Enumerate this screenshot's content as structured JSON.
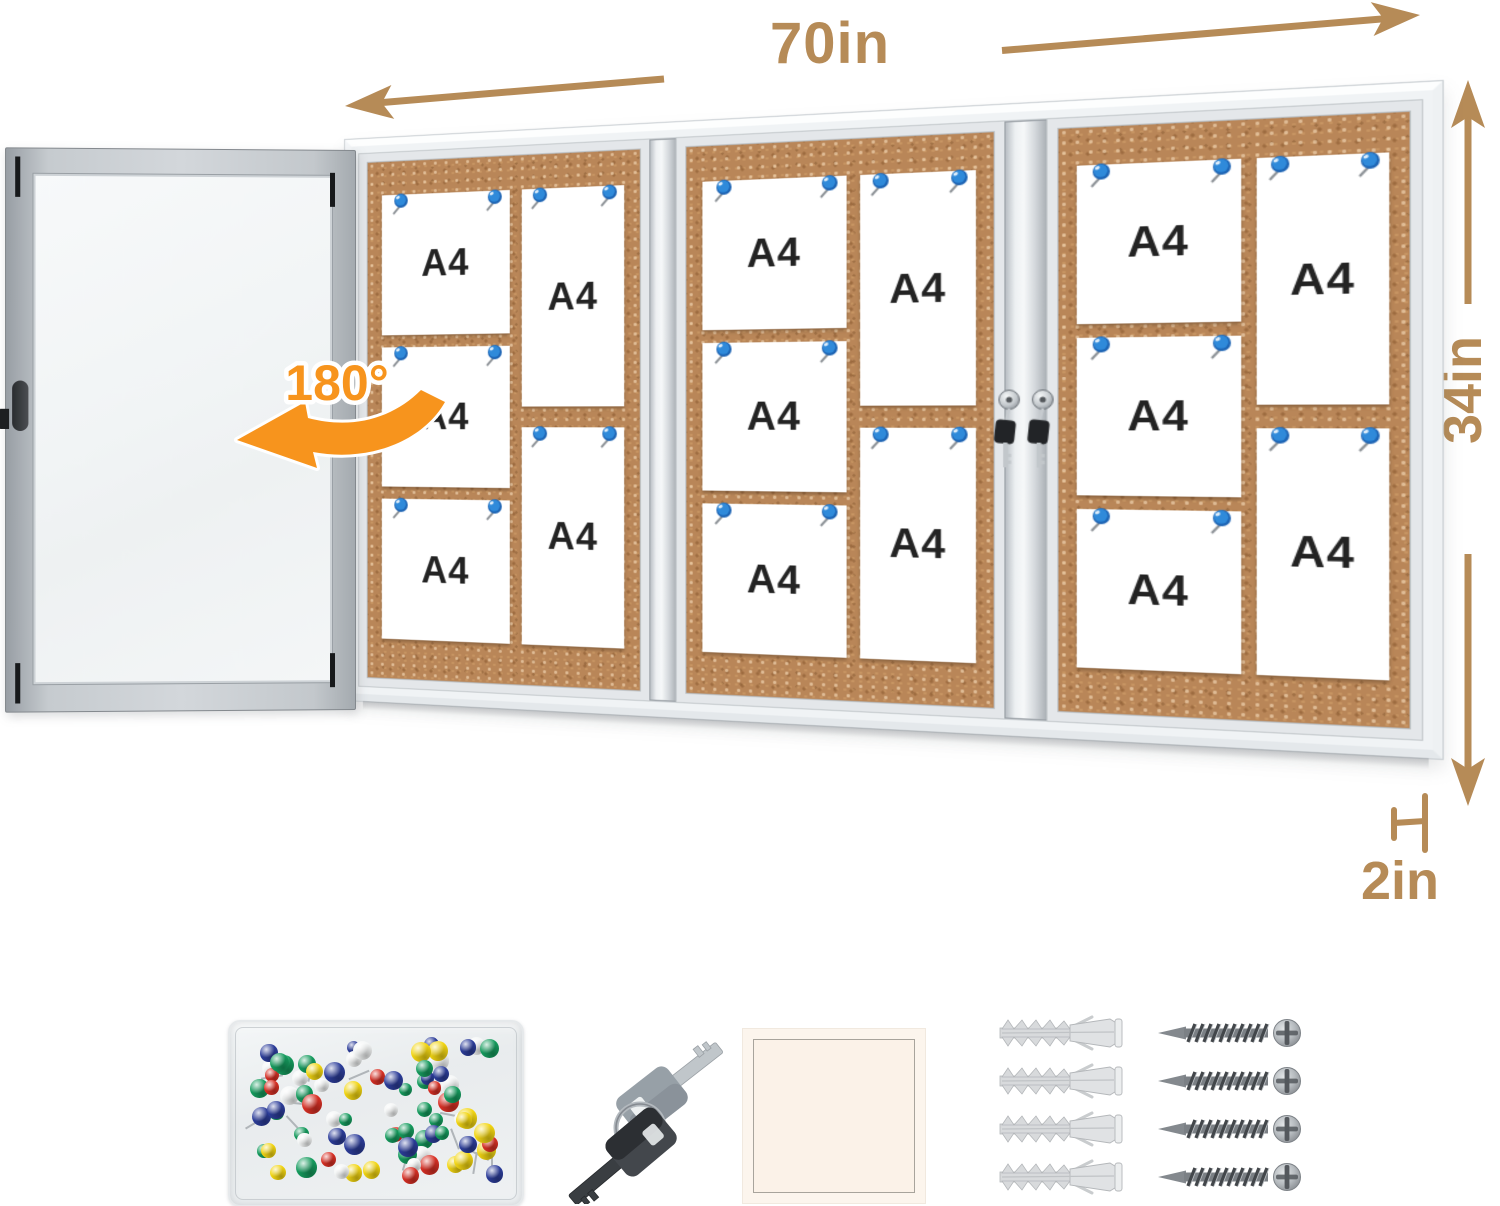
{
  "dimension_labels": {
    "width": "70in",
    "height": "34in",
    "depth": "2in",
    "door_swing": "180°"
  },
  "board": {
    "panels": [
      {
        "left_papers": [
          "A4",
          "A4",
          "A4"
        ],
        "right_papers": [
          "A4",
          "A4"
        ]
      },
      {
        "left_papers": [
          "A4",
          "A4",
          "A4"
        ],
        "right_papers": [
          "A4",
          "A4"
        ]
      },
      {
        "left_papers": [
          "A4",
          "A4",
          "A4"
        ],
        "right_papers": [
          "A4",
          "A4"
        ]
      }
    ],
    "locks_on_center_divider": 2
  },
  "door": {
    "state": "open"
  },
  "accessories": {
    "pushpin_box": {
      "pin_colors": [
        "#d93025",
        "#f3d612",
        "#159c5e",
        "#2c3d9a",
        "#f4f6f6"
      ],
      "pin_count": 80
    },
    "keys_count": 2,
    "anchors_count": 4,
    "screws_count": 4
  },
  "colors": {
    "dimension_tan": "#b68b57",
    "rotation_orange": "#f7941d",
    "cork": "#b98658",
    "pin_blue": "#2f8ada",
    "paper_text": "#232323"
  }
}
